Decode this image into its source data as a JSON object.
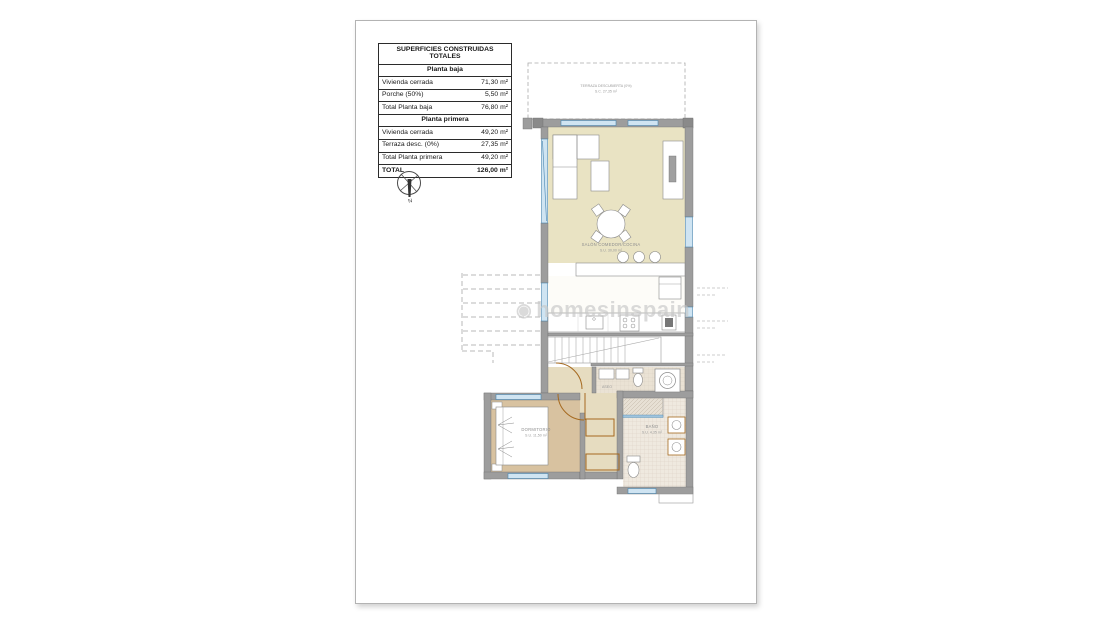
{
  "areas_table": {
    "title": "SUPERFICIES CONSTRUIDAS TOTALES",
    "rows": [
      {
        "label": "Planta baja",
        "value": ""
      },
      {
        "label": "Vivienda cerrada",
        "value": "71,30 m²"
      },
      {
        "label": "Porche (50%)",
        "value": "5,50 m²"
      },
      {
        "label": "Total Planta baja",
        "value": "76,80 m²"
      },
      {
        "label": "Planta primera",
        "value": ""
      },
      {
        "label": "Vivienda cerrada",
        "value": "49,20 m²"
      },
      {
        "label": "Terraza desc. (0%)",
        "value": "27,35 m²"
      },
      {
        "label": "Total Planta primera",
        "value": "49,20 m²"
      },
      {
        "label": "TOTAL",
        "value": "126,00 m²"
      }
    ]
  },
  "compass": {
    "north_label": "N"
  },
  "watermark": {
    "logo": "◉",
    "text": "homesinspain"
  },
  "plan": {
    "terrace": {
      "name": "TERRAZA DESCUBIERTA (0%)",
      "area": "S.C. 27,35 m²"
    },
    "living": {
      "name": "SALÓN COMEDOR/COCINA",
      "area": "S.U. 30,00 m²"
    },
    "bedroom": {
      "name": "DORMITORIO",
      "area": "S.U. 11,50 m²"
    },
    "bathroom": {
      "name": "BAÑO",
      "area": "S.U. 4,35 m²"
    },
    "aseo": {
      "name": "ASEO"
    }
  },
  "colors": {
    "wall": "#9d9d9d",
    "floor_living": "#e9e3c3",
    "floor_bedroom": "#d8c2a0",
    "floor_bath": "#efe9df",
    "floor_hall": "#e6dcc0",
    "window": "#cfe4f2",
    "window_line": "#4a86b0",
    "carpentry": "#a5691f",
    "annotation": "#b9b9b9"
  }
}
